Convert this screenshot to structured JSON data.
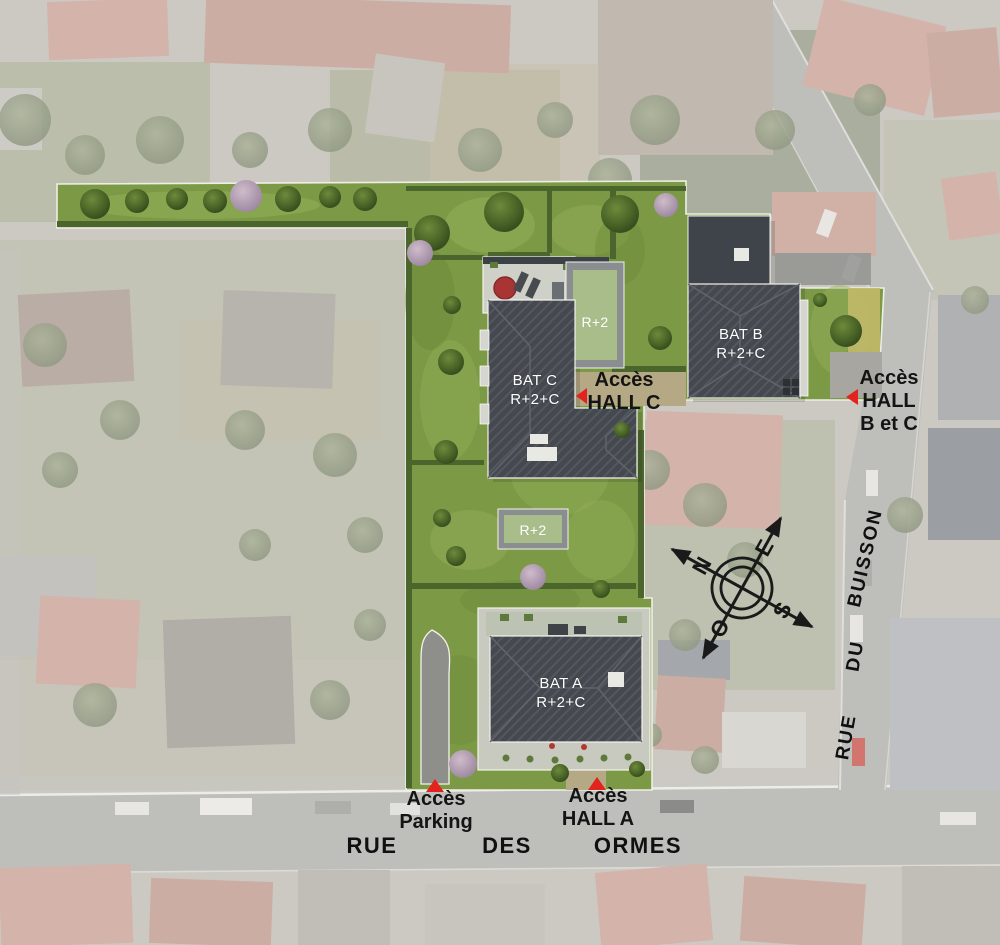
{
  "site_plan": {
    "buildings": [
      {
        "id": "bat-a",
        "name": "BAT A",
        "floors": "R+2+C"
      },
      {
        "id": "bat-b",
        "name": "BAT B",
        "floors": "R+2+C"
      },
      {
        "id": "bat-c",
        "name": "BAT C",
        "floors": "R+2+C"
      }
    ],
    "annex_roofs": [
      {
        "id": "r2-north",
        "label": "R+2"
      },
      {
        "id": "r2-south",
        "label": "R+2"
      }
    ],
    "access_points": [
      {
        "id": "hall-c",
        "line1": "Accès",
        "line2": "HALL C"
      },
      {
        "id": "hall-b-c",
        "line1": "Accès",
        "line2": "HALL",
        "line3": "B et C"
      },
      {
        "id": "parking",
        "line1": "Accès",
        "line2": "Parking"
      },
      {
        "id": "hall-a",
        "line1": "Accès",
        "line2": "HALL A"
      }
    ],
    "streets": {
      "rue_des_ormes": {
        "word1": "RUE",
        "word2": "DES",
        "word3": "ORMES"
      },
      "rue_du_buisson": {
        "word1": "RUE",
        "word2": "DU",
        "word3": "BUISSON"
      }
    },
    "compass": {
      "north": "N",
      "east": "E",
      "south": "S",
      "west": "O"
    },
    "colors": {
      "marker_red": "#e3231e",
      "site_lawn_green": "#7c9a45",
      "roof_dark_grey": "#45494f",
      "annex_roof_green": "#a9bd8b",
      "building_label": "#ffffff",
      "annotation_black": "#141414"
    }
  }
}
